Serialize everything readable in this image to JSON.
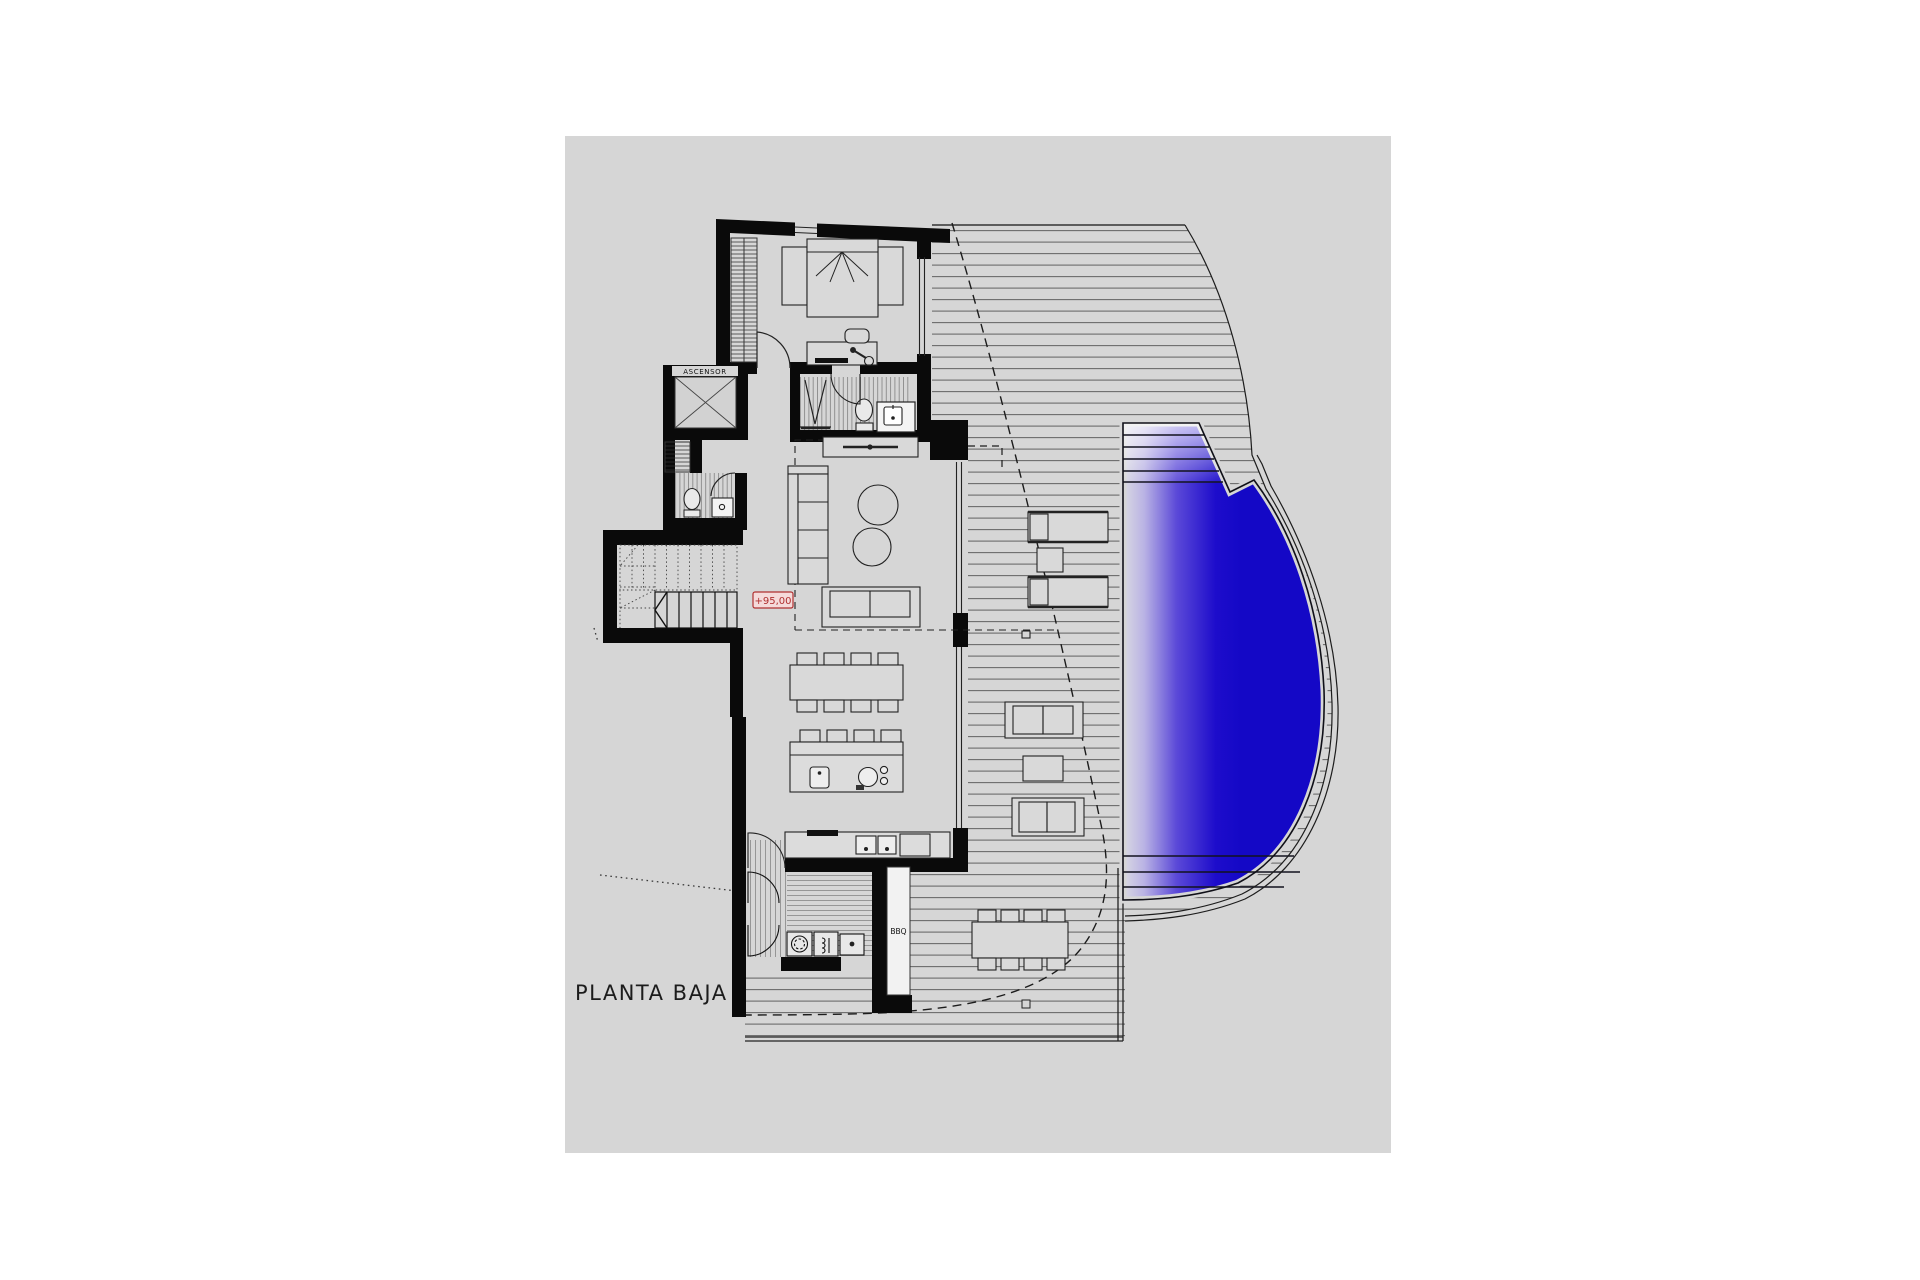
{
  "page": {
    "background": "#ffffff",
    "canvas_color": "#d6d6d6"
  },
  "plan": {
    "floor_title": "PLANTA BAJA",
    "level_marker": "+95,00",
    "elevator_label": "ASCENSOR",
    "bbq_label": "BBQ",
    "colors": {
      "wall": "#0a0a0a",
      "line": "#222222",
      "deck_line": "#6a6a6a",
      "marker_red": "#b03030",
      "marker_fill": "#f5dada",
      "pool_deep": "#1408c6",
      "pool_mid": "#5b49d8",
      "pool_light": "#dadae2"
    }
  }
}
